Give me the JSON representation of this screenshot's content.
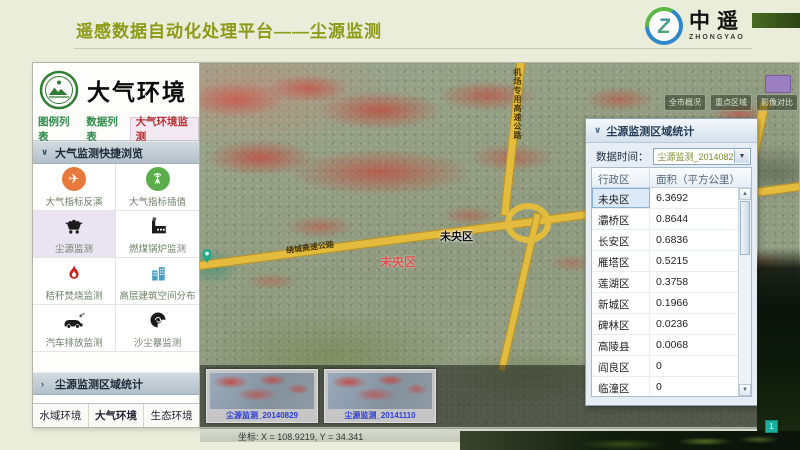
{
  "header": {
    "title": "遥感数据自动化处理平台——尘源监测",
    "logo": {
      "mark": "Z",
      "name": "中遥",
      "subname": "ZHONGYAO"
    }
  },
  "sidebar": {
    "app_title": "大气环境",
    "tabs": [
      {
        "label": "图例列表",
        "active": false
      },
      {
        "label": "数据列表",
        "active": false
      },
      {
        "label": "大气环境监测",
        "active": true
      }
    ],
    "quick_section_title": "大气监测快捷浏览",
    "tools": [
      {
        "label": "大气指标反演",
        "icon": "airplane-icon"
      },
      {
        "label": "大气指标插值",
        "icon": "signal-tower-icon"
      },
      {
        "label": "尘源监测",
        "icon": "mine-cart-icon",
        "active": true
      },
      {
        "label": "燃煤锅炉监测",
        "icon": "factory-icon"
      },
      {
        "label": "秸秆焚烧监测",
        "icon": "flame-icon"
      },
      {
        "label": "高层建筑空间分布",
        "icon": "buildings-icon"
      },
      {
        "label": "汽车排放监测",
        "icon": "car-icon"
      },
      {
        "label": "沙尘暴监测",
        "icon": "dust-storm-icon"
      }
    ],
    "stats_section_title": "尘源监测区域统计",
    "bottom_tabs": [
      "水域环境",
      "大气环境",
      "生态环境"
    ]
  },
  "map": {
    "toolbar_buttons": [
      "全市概况",
      "重点区域",
      "影像对比"
    ],
    "labels": {
      "district": "未央区",
      "district_red": "未央区",
      "ring_road": "绕城高速公路",
      "airport_road": "机场专用高速公路"
    },
    "thumbnails": [
      {
        "caption": "尘源监测_20140829"
      },
      {
        "caption": "尘源监测_20141110"
      }
    ],
    "status_text": "坐标: X = 108.9219, Y = 34.341",
    "zoom_badge": "1"
  },
  "stats_panel": {
    "title": "尘源监测区域统计",
    "time_label": "数据时间：",
    "time_value": "尘源监测_20140829",
    "table": {
      "headers": [
        "行政区",
        "面积（平方公里）"
      ],
      "rows": [
        [
          "未央区",
          "6.3692"
        ],
        [
          "灞桥区",
          "0.8644"
        ],
        [
          "长安区",
          "0.6836"
        ],
        [
          "雁塔区",
          "0.5215"
        ],
        [
          "莲湖区",
          "0.3758"
        ],
        [
          "新城区",
          "0.1966"
        ],
        [
          "碑林区",
          "0.0236"
        ],
        [
          "高陵县",
          "0.0068"
        ],
        [
          "阎良区",
          "0"
        ],
        [
          "临潼区",
          "0"
        ]
      ]
    }
  },
  "colors": {
    "accent_title": "#8c9a15",
    "active_tab_red": "#b83232",
    "tab_green": "#2e8b4a",
    "panel_blue": "#e7edf5",
    "road_yellow": "#e3bc3e",
    "dust_red": "#c63e34"
  }
}
